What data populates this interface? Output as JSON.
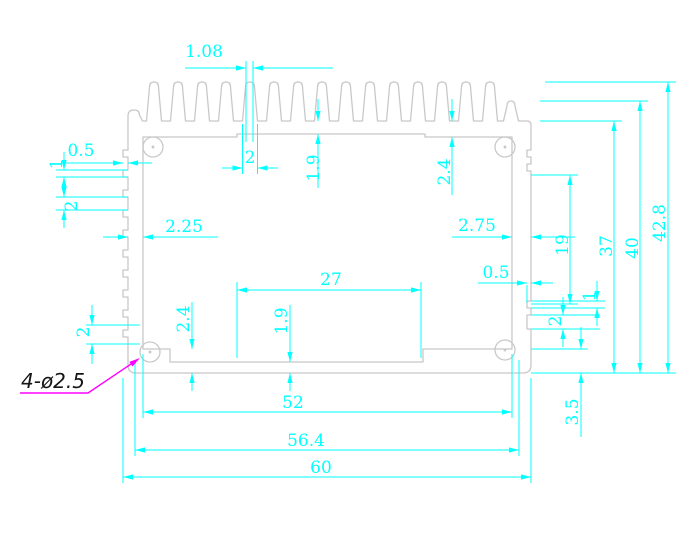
{
  "drawing": {
    "title": "Heatsink enclosure extrusion cross-section",
    "colors": {
      "outline": "#c8c8c8",
      "dimension": "#00ffff",
      "leader": "#ff00ff",
      "callout_text": "#161616",
      "background": "#ffffff"
    },
    "callout": {
      "hole_note": "4-ø2.5"
    },
    "dims": {
      "fin_top_width": "1.08",
      "left_tooth_depth": "0.5",
      "left_tooth_height": "1",
      "left_tooth_gap": "2",
      "left_wall_thickness": "2.25",
      "fin_base_width": "2",
      "top_plate_mid_thickness": "1.9",
      "top_plate_side_thickness": "2.4",
      "right_wall_thickness": "2.75",
      "right_wall_smooth_section": "19",
      "height_to_fin_base": "37",
      "height_to_edge_fin": "40",
      "overall_height": "42.8",
      "right_notch_depth": "0.5",
      "right_notch_small": "1",
      "right_notch_large": "2",
      "ceiling_recess_width": "27",
      "floor_channel_depth": "1.9",
      "floor_side_thickness": "2.4",
      "left_bottom_notch": "2",
      "base_thickness": "3.5",
      "cavity_width": "52",
      "body_width": "56.4",
      "overall_width": "60"
    }
  }
}
